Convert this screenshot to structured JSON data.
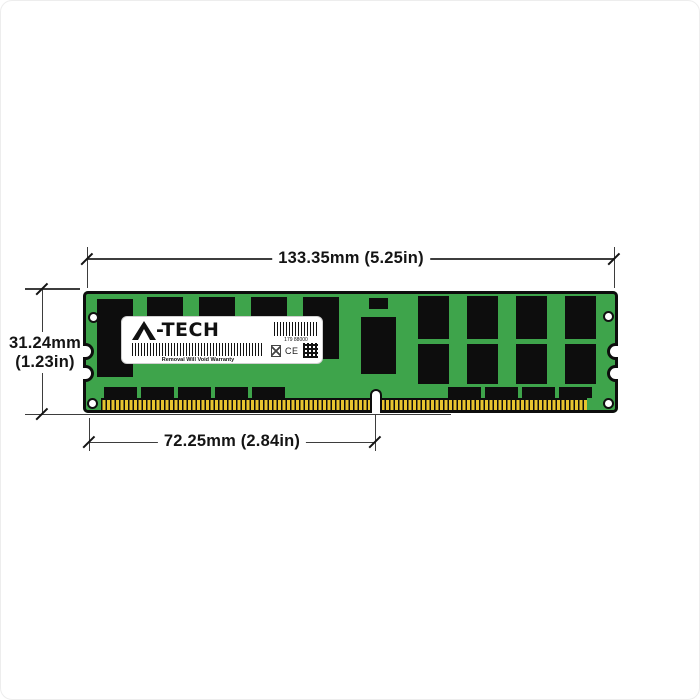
{
  "diagram": {
    "dimensions": {
      "width": "133.35mm (5.25in)",
      "height_mm": "31.24mm",
      "height_in": "(1.23in)",
      "key_offset": "72.25mm (2.84in)"
    },
    "label": {
      "brand": "A-TECH",
      "brand_suffix": "-TECH",
      "serial": "179 88000",
      "warranty": "Removal Will Void Warranty",
      "ce": "CE"
    },
    "colors": {
      "pcb_green": "#3ea44b",
      "chip_black": "#0d0d0d",
      "pin_gold": "#e7c42f",
      "dimension_line": "#3d3d3d"
    }
  }
}
